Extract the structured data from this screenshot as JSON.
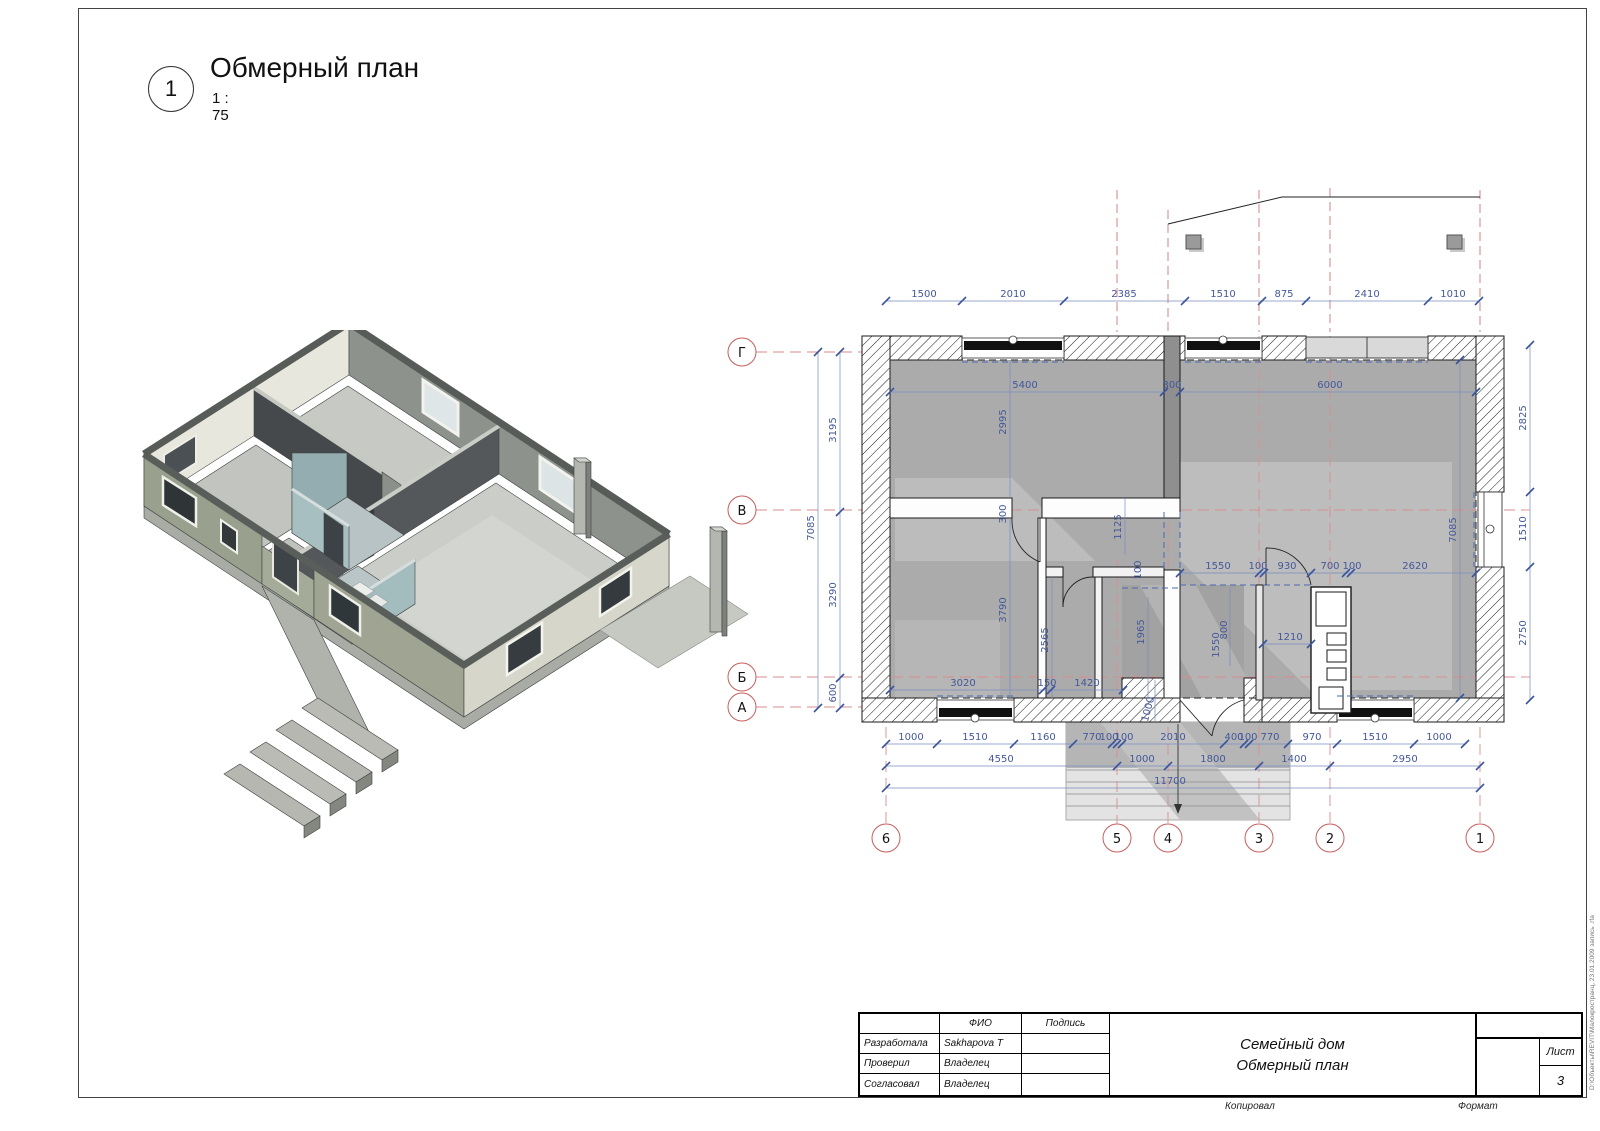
{
  "colors": {
    "dim_blue": "#44589b",
    "grid_red": "#d98e8e",
    "bubble_red": "#c65f5f",
    "room_gray": "#ababab"
  },
  "sheet": {
    "view_number": "1",
    "view_title": "Обмерный план",
    "view_scale": "1 : 75",
    "footer": {
      "copied": "Копировал",
      "format": "Формат"
    },
    "watermark": "D:\\Объекты\\REVIT\\Малокространц, 23.01.2009  запись .rfa",
    "title_block": {
      "col_fio": "ФИО",
      "col_sign": "Подпись",
      "rows": [
        {
          "role": "Разработала",
          "name": "Sakhapova T"
        },
        {
          "role": "Проверил",
          "name": "Владелец"
        },
        {
          "role": "Согласовал",
          "name": "Владелец"
        }
      ],
      "project": "Семейный дом",
      "drawing": "Обмерный план",
      "sheet_label": "Лист",
      "sheet_number": "3"
    }
  },
  "plan": {
    "grid": {
      "rows": [
        "Г",
        "В",
        "Б",
        "А"
      ],
      "cols": [
        "6",
        "5",
        "4",
        "3",
        "2",
        "1"
      ]
    },
    "dims_top": [
      "1500",
      "2010",
      "2385",
      "1510",
      "875",
      "2410",
      "1010"
    ],
    "dims_bottom_a": [
      "1000",
      "1510",
      "1160",
      "770",
      "100",
      "100",
      "2010",
      "400",
      "100",
      "770",
      "970",
      "1510",
      "1000"
    ],
    "dims_bottom_b": [
      "4550",
      "1000",
      "1800",
      "1400",
      "2950"
    ],
    "dims_bottom_total": "11700",
    "dims_left": [
      "3195",
      "3290",
      "600"
    ],
    "dims_left_total": "7085",
    "dims_right": [
      "2825",
      "1510",
      "2750"
    ],
    "dims_right_total": "7085",
    "dims_interior": [
      "5400",
      "300",
      "6000",
      "2995",
      "300",
      "1125",
      "100",
      "3790",
      "2565",
      "1965",
      "1550",
      "100",
      "930",
      "700",
      "100",
      "2620",
      "800",
      "1550",
      "1210",
      "3020",
      "150",
      "1420",
      "1000"
    ]
  }
}
